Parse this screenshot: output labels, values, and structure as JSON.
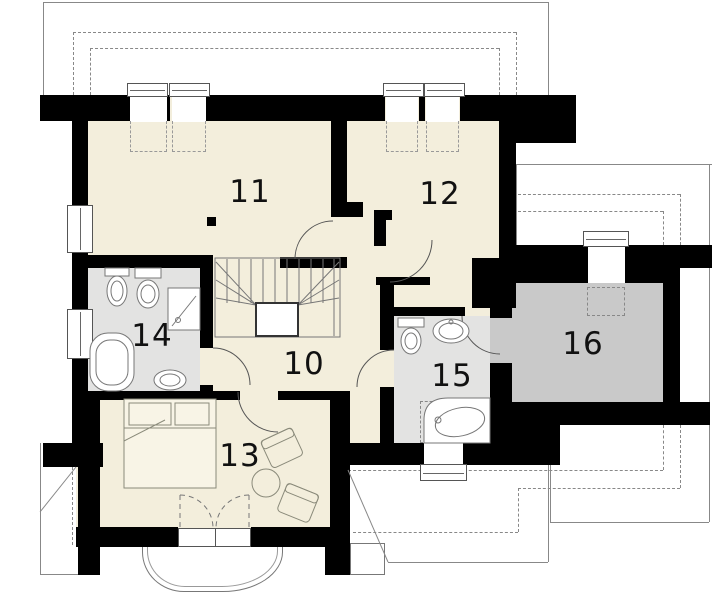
{
  "plan": {
    "rooms": [
      {
        "number": "10",
        "role": "hallway-stairs"
      },
      {
        "number": "11",
        "role": "bedroom"
      },
      {
        "number": "12",
        "role": "bedroom"
      },
      {
        "number": "13",
        "role": "bedroom"
      },
      {
        "number": "14",
        "role": "bathroom"
      },
      {
        "number": "15",
        "role": "bathroom"
      },
      {
        "number": "16",
        "role": "storage-room"
      }
    ],
    "colors": {
      "room_floor": "#f3eedc",
      "bathroom_floor": "#e3e3e2",
      "storage_floor": "#c9c9c9",
      "walls": "#000000",
      "lines": "#777777"
    }
  }
}
